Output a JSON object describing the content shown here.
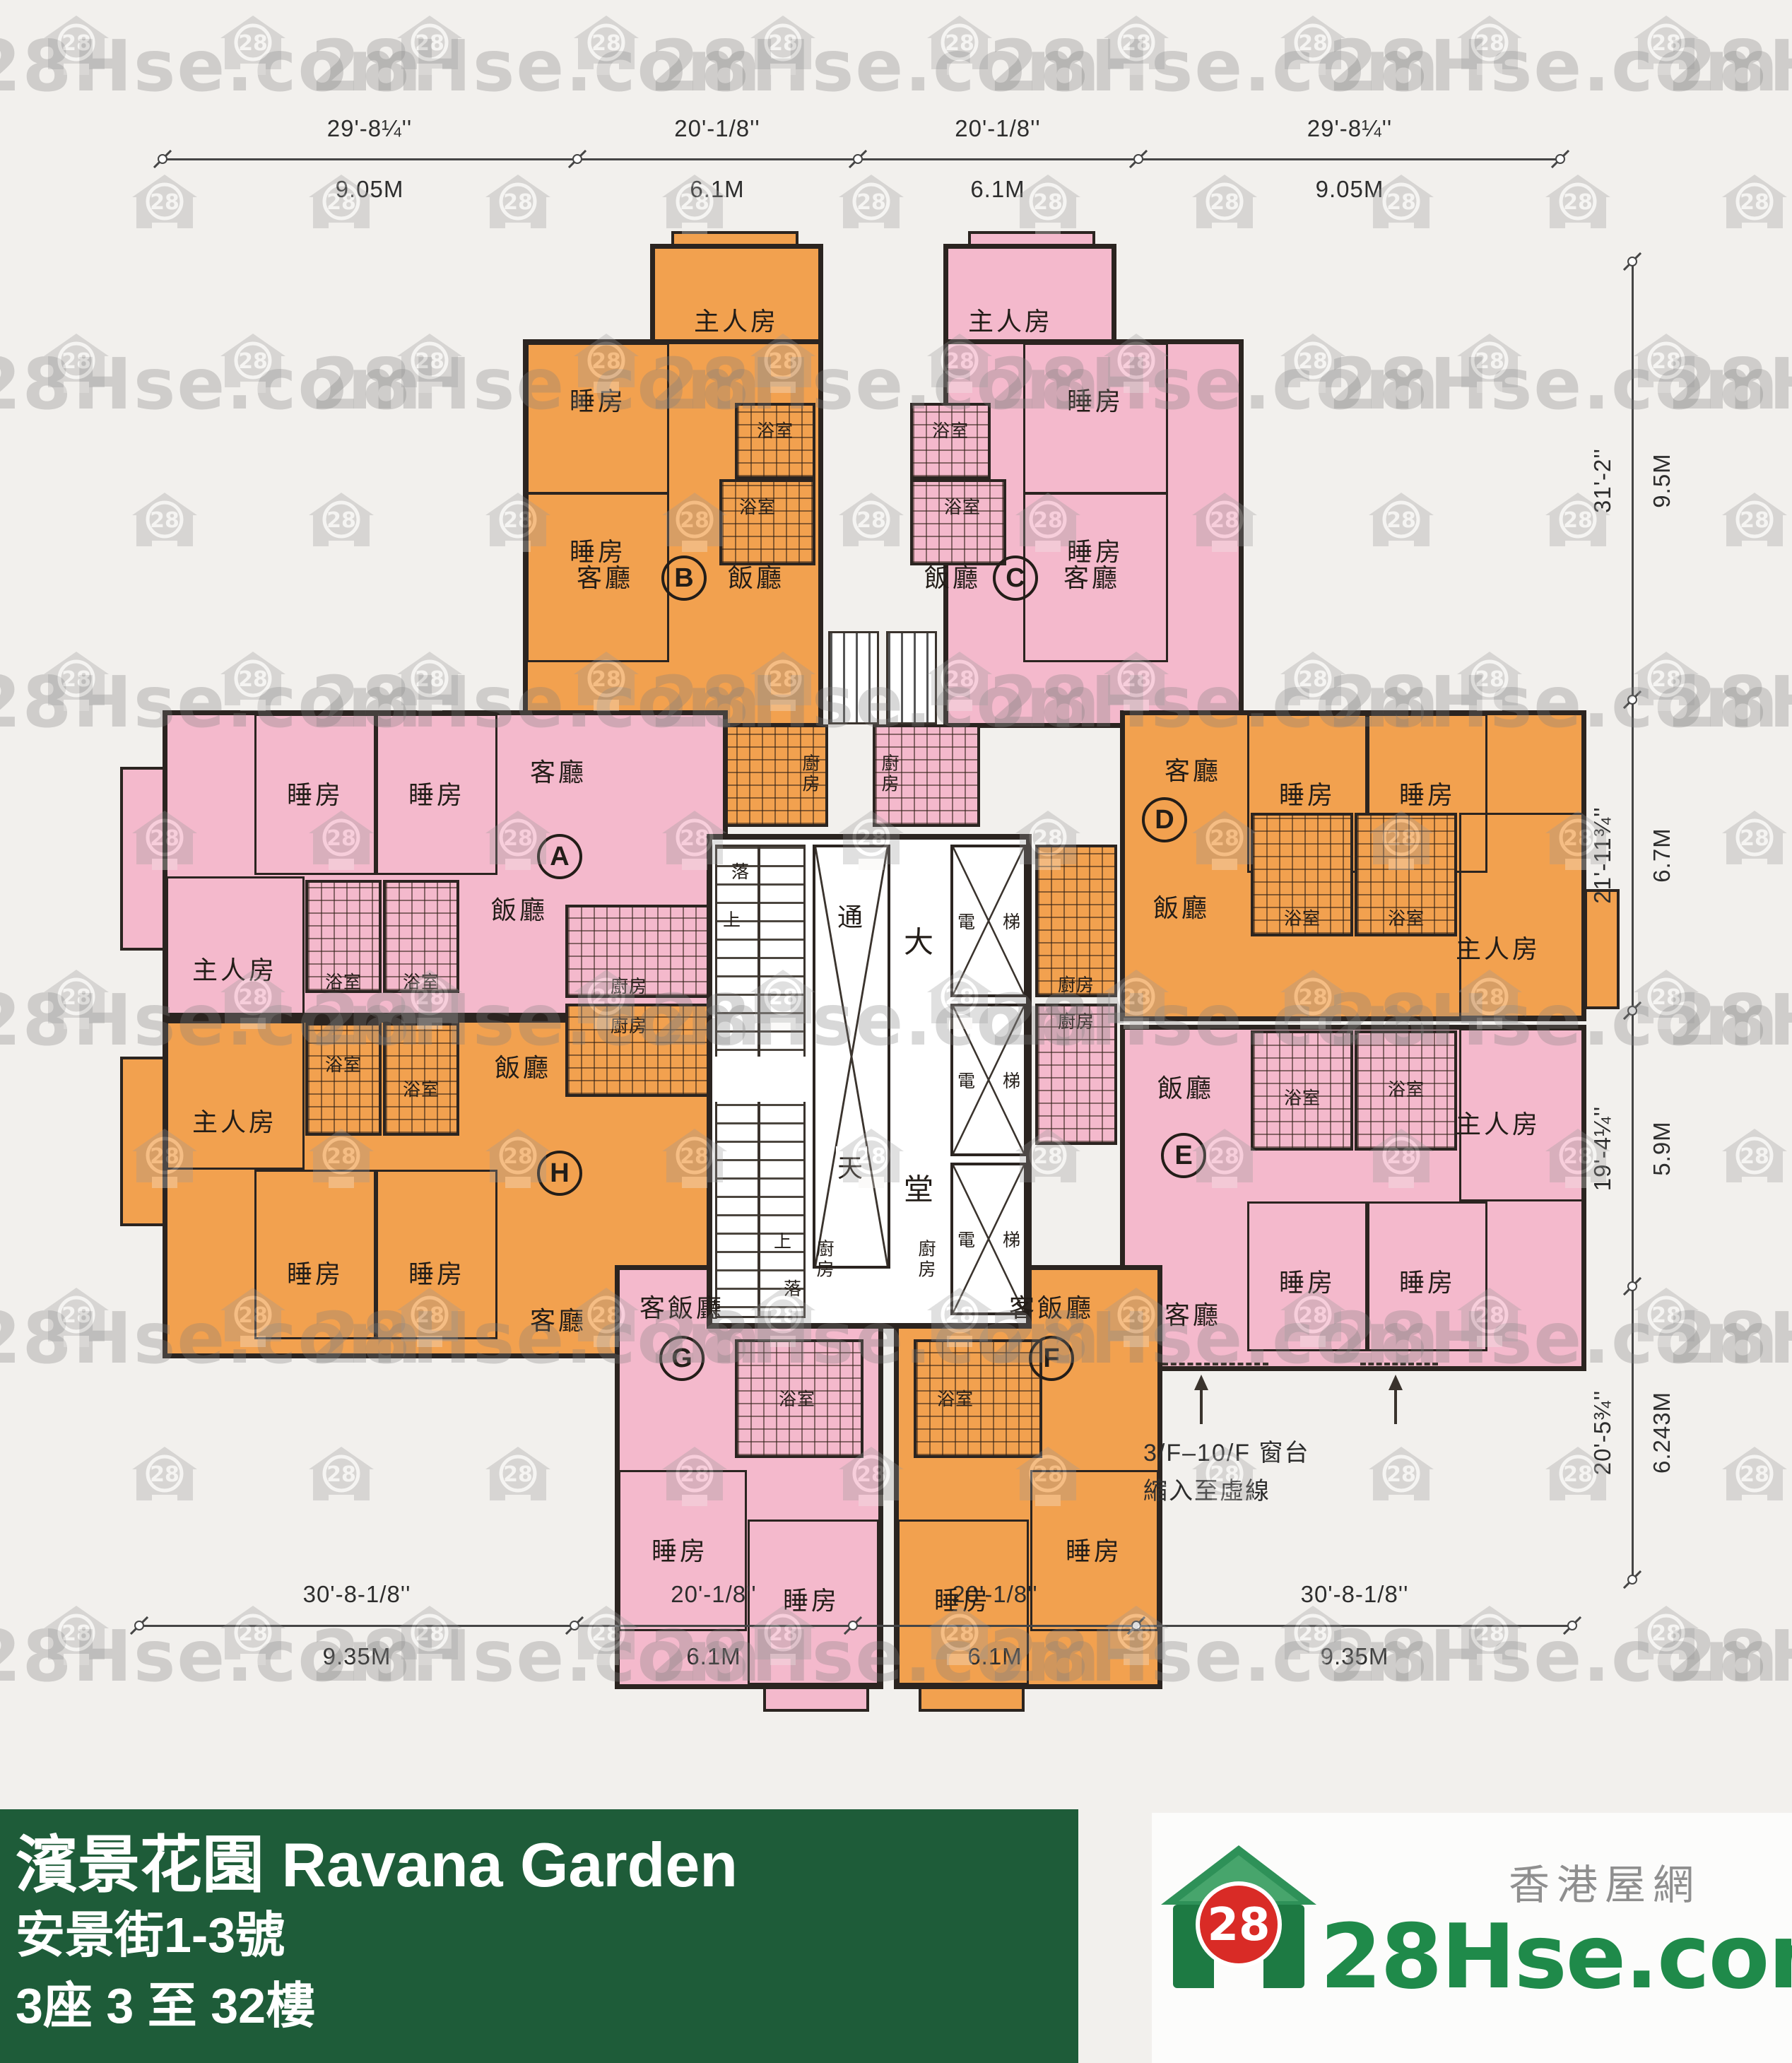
{
  "watermark": {
    "text": "28Hse.com",
    "icon_number": "28"
  },
  "footer": {
    "title_line1": "濱景花園 Ravana Garden",
    "title_line2": "安景街1-3號",
    "title_line3": "3座 3 至 32樓"
  },
  "logo": {
    "site_cn": "香港屋網",
    "site_en": "28Hse.com",
    "badge": "28"
  },
  "annotation": {
    "line1": "3/F–10/F 窗台",
    "line2": "縮入至虛線"
  },
  "rooms": {
    "master": "主人房",
    "bed": "睡房",
    "living": "客廳",
    "dining": "飯廳",
    "living_dining": "客飯廳",
    "bath": "浴室",
    "kitchen": "廚房"
  },
  "units": {
    "a": "A",
    "b": "B",
    "c": "C",
    "d": "D",
    "e": "E",
    "f": "F",
    "g": "G",
    "h": "H"
  },
  "core": {
    "up": "上",
    "down": "落",
    "well_top": "通",
    "well_bottom": "天",
    "lobby_top": "大",
    "lobby_bottom": "堂",
    "lift_left": "電",
    "lift_right": "梯"
  },
  "dims": {
    "top": [
      {
        "ft": "29'-8¼''",
        "m": "9.05M"
      },
      {
        "ft": "20'-1/8''",
        "m": "6.1M"
      },
      {
        "ft": "20'-1/8''",
        "m": "6.1M"
      },
      {
        "ft": "29'-8¼''",
        "m": "9.05M"
      }
    ],
    "bottom": [
      {
        "ft": "30'-8-1/8''",
        "m": "9.35M"
      },
      {
        "ft": "20'-1/8''",
        "m": "6.1M"
      },
      {
        "ft": "20'-1/8''",
        "m": "6.1M"
      },
      {
        "ft": "30'-8-1/8''",
        "m": "9.35M"
      }
    ],
    "right": [
      {
        "ft": "31'-2''",
        "m": "9.5M"
      },
      {
        "ft": "21'-11¾''",
        "m": "6.7M"
      },
      {
        "ft": "19'-4¼''",
        "m": "5.9M"
      },
      {
        "ft": "20'-5¾''",
        "m": "6.243M"
      }
    ]
  }
}
